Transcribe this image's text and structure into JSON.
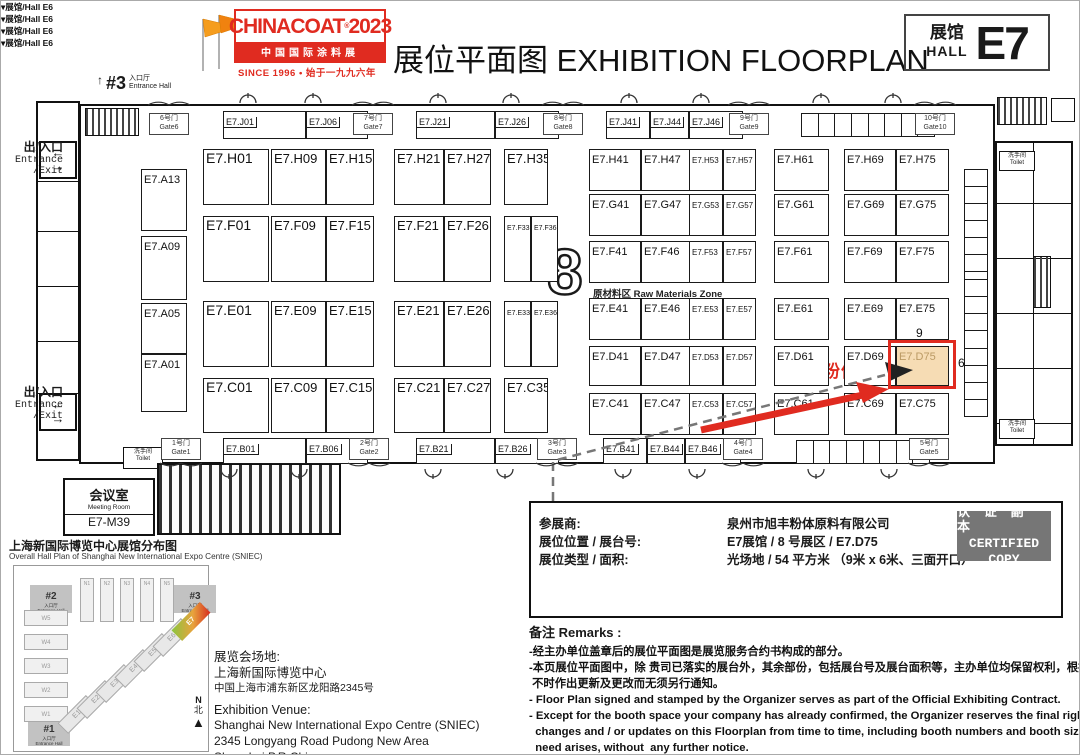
{
  "header": {
    "logo": {
      "brand": "CHINACOAT",
      "reg": "®",
      "year": "2023",
      "band": "中国国际涂料展",
      "since": "SINCE 1996 • 始于一九九六年"
    },
    "title_zh": "展位平面图",
    "title_en": "EXHIBITION FLOORPLAN",
    "hall_badge": {
      "zh": "展馆",
      "en": "HALL",
      "code": "E7"
    },
    "accent_red": "#e02b20"
  },
  "plan": {
    "entrance3": {
      "arrow": "↑",
      "num": "#3",
      "zh": "入口厅",
      "en": "Entrance Hall"
    },
    "exit_zh": "出/入口",
    "exit_en1": "Entrance",
    "exit_en2": "/Exit",
    "zone_number": "8",
    "raw_zone": "原材料区  Raw Materials Zone",
    "hall_e6": "▾展馆/Hall  E6",
    "toilet_zh": "洗手间",
    "toilet_en": "Toilet",
    "meeting": {
      "zh": "会议室",
      "en": "Meeting Room",
      "code": "E7-M39"
    },
    "highlight": {
      "company": "旭丰粉体",
      "dim_top": "9",
      "dim_right": "6",
      "booth": "E7.D75"
    },
    "arrows_updown": "← →",
    "gates_top": [
      {
        "zh": "6号门",
        "en": "Gate6",
        "x": 168
      },
      {
        "zh": "7号门",
        "en": "Gate7",
        "x": 372
      },
      {
        "zh": "8号门",
        "en": "Gate8",
        "x": 562
      },
      {
        "zh": "9号门",
        "en": "Gate9",
        "x": 748
      },
      {
        "zh": "10号门",
        "en": "Gate10",
        "x": 934
      }
    ],
    "gates_bottom": [
      {
        "zh": "1号门",
        "en": "Gate1",
        "x": 180
      },
      {
        "zh": "2号门",
        "en": "Gate2",
        "x": 368
      },
      {
        "zh": "3号门",
        "en": "Gate3",
        "x": 556
      },
      {
        "zh": "4号门",
        "en": "Gate4",
        "x": 742
      },
      {
        "zh": "5号门",
        "en": "Gate5",
        "x": 928
      }
    ],
    "hall_e6_positions": [
      186,
      376,
      752,
      938
    ],
    "booths": [
      {
        "label": "E7.J01",
        "x": 222,
        "y": 110,
        "w": 83,
        "h": 28,
        "fs": 9,
        "cell": 1
      },
      {
        "label": "E7.J06",
        "x": 305,
        "y": 110,
        "w": 62,
        "h": 28,
        "fs": 9,
        "cell": 1
      },
      {
        "label": "E7.J21",
        "x": 415,
        "y": 110,
        "w": 79,
        "h": 28,
        "fs": 9,
        "cell": 1
      },
      {
        "label": "E7.J26",
        "x": 494,
        "y": 110,
        "w": 64,
        "h": 28,
        "fs": 9,
        "cell": 1
      },
      {
        "label": "E7.J41",
        "x": 605,
        "y": 110,
        "w": 44,
        "h": 28,
        "fs": 9,
        "cell": 1
      },
      {
        "label": "E7.J44",
        "x": 649,
        "y": 110,
        "w": 39,
        "h": 28,
        "fs": 9,
        "cell": 1
      },
      {
        "label": "E7.J46",
        "x": 688,
        "y": 110,
        "w": 54,
        "h": 28,
        "fs": 9,
        "cell": 1
      },
      {
        "label": "E7.A13",
        "x": 140,
        "y": 168,
        "w": 46,
        "h": 62,
        "fs": 11
      },
      {
        "label": "E7.A09",
        "x": 140,
        "y": 235,
        "w": 46,
        "h": 64,
        "fs": 11
      },
      {
        "label": "E7.A05",
        "x": 140,
        "y": 302,
        "w": 46,
        "h": 51,
        "fs": 11
      },
      {
        "label": "E7.A01",
        "x": 140,
        "y": 353,
        "w": 46,
        "h": 58,
        "fs": 11
      },
      {
        "label": "E7.H01",
        "x": 202,
        "y": 148,
        "w": 66,
        "h": 56,
        "fs": 14
      },
      {
        "label": "E7.H09",
        "x": 270,
        "y": 148,
        "w": 55,
        "h": 56,
        "fs": 13
      },
      {
        "label": "E7.H15",
        "x": 325,
        "y": 148,
        "w": 48,
        "h": 56,
        "fs": 13
      },
      {
        "label": "E7.H21",
        "x": 393,
        "y": 148,
        "w": 50,
        "h": 56,
        "fs": 13
      },
      {
        "label": "E7.H27",
        "x": 443,
        "y": 148,
        "w": 47,
        "h": 56,
        "fs": 13
      },
      {
        "label": "E7.H35",
        "x": 503,
        "y": 148,
        "w": 44,
        "h": 56,
        "fs": 13
      },
      {
        "label": "E7.H41",
        "x": 588,
        "y": 148,
        "w": 52,
        "h": 42
      },
      {
        "label": "E7.H47",
        "x": 640,
        "y": 148,
        "w": 55,
        "h": 42
      },
      {
        "label": "E7.H53",
        "x": 688,
        "y": 148,
        "w": 34,
        "h": 42,
        "fs": 8
      },
      {
        "label": "E7.H57",
        "x": 722,
        "y": 148,
        "w": 33,
        "h": 42,
        "fs": 8
      },
      {
        "label": "E7.H61",
        "x": 773,
        "y": 148,
        "w": 55,
        "h": 42
      },
      {
        "label": "E7.H69",
        "x": 843,
        "y": 148,
        "w": 52,
        "h": 42
      },
      {
        "label": "E7.H75",
        "x": 895,
        "y": 148,
        "w": 53,
        "h": 42
      },
      {
        "label": "E7.G41",
        "x": 588,
        "y": 193,
        "w": 52,
        "h": 42
      },
      {
        "label": "E7.G47",
        "x": 640,
        "y": 193,
        "w": 55,
        "h": 42
      },
      {
        "label": "E7.G53",
        "x": 688,
        "y": 193,
        "w": 34,
        "h": 42,
        "fs": 8
      },
      {
        "label": "E7.G57",
        "x": 722,
        "y": 193,
        "w": 33,
        "h": 42,
        "fs": 8
      },
      {
        "label": "E7.G61",
        "x": 773,
        "y": 193,
        "w": 55,
        "h": 42
      },
      {
        "label": "E7.G69",
        "x": 843,
        "y": 193,
        "w": 52,
        "h": 42
      },
      {
        "label": "E7.G75",
        "x": 895,
        "y": 193,
        "w": 53,
        "h": 42
      },
      {
        "label": "E7.F01",
        "x": 202,
        "y": 215,
        "w": 66,
        "h": 66,
        "fs": 14
      },
      {
        "label": "E7.F09",
        "x": 270,
        "y": 215,
        "w": 55,
        "h": 66,
        "fs": 13
      },
      {
        "label": "E7.F15",
        "x": 325,
        "y": 215,
        "w": 48,
        "h": 66,
        "fs": 13
      },
      {
        "label": "E7.F21",
        "x": 393,
        "y": 215,
        "w": 50,
        "h": 66,
        "fs": 13
      },
      {
        "label": "E7.F26",
        "x": 443,
        "y": 215,
        "w": 47,
        "h": 66,
        "fs": 13
      },
      {
        "label": "E7.F33",
        "x": 503,
        "y": 215,
        "w": 27,
        "h": 66,
        "fs": 7
      },
      {
        "label": "E7.F36",
        "x": 530,
        "y": 215,
        "w": 27,
        "h": 66,
        "fs": 7
      },
      {
        "label": "E7.F41",
        "x": 588,
        "y": 240,
        "w": 52,
        "h": 42
      },
      {
        "label": "E7.F46",
        "x": 640,
        "y": 240,
        "w": 55,
        "h": 42
      },
      {
        "label": "E7.F53",
        "x": 688,
        "y": 240,
        "w": 34,
        "h": 42,
        "fs": 8
      },
      {
        "label": "E7.F57",
        "x": 722,
        "y": 240,
        "w": 33,
        "h": 42,
        "fs": 8
      },
      {
        "label": "E7.F61",
        "x": 773,
        "y": 240,
        "w": 55,
        "h": 42
      },
      {
        "label": "E7.F69",
        "x": 843,
        "y": 240,
        "w": 52,
        "h": 42
      },
      {
        "label": "E7.F75",
        "x": 895,
        "y": 240,
        "w": 53,
        "h": 42
      },
      {
        "label": "E7.E01",
        "x": 202,
        "y": 300,
        "w": 66,
        "h": 66,
        "fs": 14
      },
      {
        "label": "E7.E09",
        "x": 270,
        "y": 300,
        "w": 55,
        "h": 66,
        "fs": 13
      },
      {
        "label": "E7.E15",
        "x": 325,
        "y": 300,
        "w": 48,
        "h": 66,
        "fs": 13
      },
      {
        "label": "E7.E21",
        "x": 393,
        "y": 300,
        "w": 50,
        "h": 66,
        "fs": 13
      },
      {
        "label": "E7.E26",
        "x": 443,
        "y": 300,
        "w": 47,
        "h": 66,
        "fs": 13
      },
      {
        "label": "E7.E33",
        "x": 503,
        "y": 300,
        "w": 27,
        "h": 66,
        "fs": 7
      },
      {
        "label": "E7.E36",
        "x": 530,
        "y": 300,
        "w": 27,
        "h": 66,
        "fs": 7
      },
      {
        "label": "E7.E41",
        "x": 588,
        "y": 297,
        "w": 52,
        "h": 42
      },
      {
        "label": "E7.E46",
        "x": 640,
        "y": 297,
        "w": 55,
        "h": 42
      },
      {
        "label": "E7.E53",
        "x": 688,
        "y": 297,
        "w": 34,
        "h": 42,
        "fs": 8
      },
      {
        "label": "E7.E57",
        "x": 722,
        "y": 297,
        "w": 33,
        "h": 42,
        "fs": 8
      },
      {
        "label": "E7.E61",
        "x": 773,
        "y": 297,
        "w": 55,
        "h": 42
      },
      {
        "label": "E7.E69",
        "x": 843,
        "y": 297,
        "w": 52,
        "h": 42
      },
      {
        "label": "E7.E75",
        "x": 895,
        "y": 297,
        "w": 53,
        "h": 42
      },
      {
        "label": "E7.D41",
        "x": 588,
        "y": 345,
        "w": 52,
        "h": 40
      },
      {
        "label": "E7.D47",
        "x": 640,
        "y": 345,
        "w": 55,
        "h": 40
      },
      {
        "label": "E7.D53",
        "x": 688,
        "y": 345,
        "w": 34,
        "h": 40,
        "fs": 8
      },
      {
        "label": "E7.D57",
        "x": 722,
        "y": 345,
        "w": 33,
        "h": 40,
        "fs": 8
      },
      {
        "label": "E7.D61",
        "x": 773,
        "y": 345,
        "w": 55,
        "h": 40
      },
      {
        "label": "E7.D69",
        "x": 843,
        "y": 345,
        "w": 52,
        "h": 40
      },
      {
        "label": "E7.D75",
        "x": 895,
        "y": 345,
        "w": 53,
        "h": 40,
        "hl": 1
      },
      {
        "label": "E7.C01",
        "x": 202,
        "y": 377,
        "w": 66,
        "h": 55,
        "fs": 14
      },
      {
        "label": "E7.C09",
        "x": 270,
        "y": 377,
        "w": 55,
        "h": 55,
        "fs": 13
      },
      {
        "label": "E7.C15",
        "x": 325,
        "y": 377,
        "w": 48,
        "h": 55,
        "fs": 13
      },
      {
        "label": "E7.C21",
        "x": 393,
        "y": 377,
        "w": 50,
        "h": 55,
        "fs": 13
      },
      {
        "label": "E7.C27",
        "x": 443,
        "y": 377,
        "w": 47,
        "h": 55,
        "fs": 13
      },
      {
        "label": "E7.C35",
        "x": 503,
        "y": 377,
        "w": 44,
        "h": 55,
        "fs": 13
      },
      {
        "label": "E7.C41",
        "x": 588,
        "y": 392,
        "w": 52,
        "h": 42
      },
      {
        "label": "E7.C47",
        "x": 640,
        "y": 392,
        "w": 55,
        "h": 42
      },
      {
        "label": "E7.C53",
        "x": 688,
        "y": 392,
        "w": 34,
        "h": 42,
        "fs": 8
      },
      {
        "label": "E7.C57",
        "x": 722,
        "y": 392,
        "w": 33,
        "h": 42,
        "fs": 8
      },
      {
        "label": "E7.C61",
        "x": 773,
        "y": 392,
        "w": 55,
        "h": 42
      },
      {
        "label": "E7.C69",
        "x": 843,
        "y": 392,
        "w": 52,
        "h": 42
      },
      {
        "label": "E7.C75",
        "x": 895,
        "y": 392,
        "w": 53,
        "h": 42
      },
      {
        "label": "E7.B01",
        "x": 222,
        "y": 437,
        "w": 83,
        "h": 26,
        "fs": 9,
        "cell": 1
      },
      {
        "label": "E7.B06",
        "x": 305,
        "y": 437,
        "w": 62,
        "h": 26,
        "fs": 9,
        "cell": 1
      },
      {
        "label": "E7.B21",
        "x": 415,
        "y": 437,
        "w": 79,
        "h": 26,
        "fs": 9,
        "cell": 1
      },
      {
        "label": "E7.B26",
        "x": 494,
        "y": 437,
        "w": 64,
        "h": 26,
        "fs": 9,
        "cell": 1
      },
      {
        "label": "E7.B41",
        "x": 602,
        "y": 437,
        "w": 44,
        "h": 26,
        "fs": 9,
        "cell": 1
      },
      {
        "label": "E7.B44",
        "x": 646,
        "y": 437,
        "w": 38,
        "h": 26,
        "fs": 9,
        "cell": 1
      },
      {
        "label": "E7.B46",
        "x": 684,
        "y": 437,
        "w": 56,
        "h": 26,
        "fs": 9,
        "cell": 1
      }
    ],
    "strips": [
      {
        "x": 800,
        "y": 112,
        "w": 134,
        "h": 24,
        "cells": 8,
        "dir": "h"
      },
      {
        "x": 795,
        "y": 439,
        "w": 134,
        "h": 24,
        "cells": 8,
        "dir": "h"
      },
      {
        "x": 963,
        "y": 168,
        "w": 24,
        "h": 120,
        "cells": 7,
        "dir": "v"
      },
      {
        "x": 963,
        "y": 278,
        "w": 24,
        "h": 138,
        "cells": 8,
        "dir": "v"
      }
    ]
  },
  "info": {
    "rows": [
      {
        "k": "参展商:",
        "v": "泉州市旭丰粉体原料有限公司"
      },
      {
        "k": "展位位置 / 展台号:",
        "v": "E7展馆  /  8 号展区  /  E7.D75"
      },
      {
        "k": "展位类型 / 面积:",
        "v": "光场地  /  54 平方米  （9米 x 6米、三面开口）"
      }
    ],
    "certified": [
      "认 证 副 本",
      "CERTIFIED",
      "COPY"
    ]
  },
  "remarks": {
    "title": "备注  Remarks :",
    "lines": [
      "-经主办单位盖章后的展位平面图是展览服务合约书构成的部分。",
      "-本页展位平面图中，除 贵司已落实的展台外，其余部份，包括展台号及展台面积等，主办单位均保留权利，根据需要",
      " 不时作出更新及更改而无须另行通知。",
      "- Floor Plan signed and stamped by the Organizer serves as part of the Official Exhibiting Contract.",
      "- Except for the booth space your company has already confirmed, the Organizer reserves the final right to make further",
      "  changes and / or updates on this Floorplan from time to time, including booth numbers and booth sizes, etc., when the",
      "  need arises, without  any further notice."
    ]
  },
  "minimap": {
    "title_zh": "上海新国际博览中心展馆分布图",
    "title_en": "Overall Hall Plan of Shanghai New International Expo Centre (SNIEC)",
    "entrances": [
      {
        "num": "#2",
        "zh": "入口厅",
        "en": "Entrance Hall",
        "x": 28,
        "y": 583
      },
      {
        "num": "#3",
        "zh": "入口厅",
        "en": "Entrance Hall",
        "x": 172,
        "y": 583
      },
      {
        "num": "#1",
        "zh": "入口厅",
        "en": "Entrance Hall",
        "x": 26,
        "y": 716
      }
    ],
    "north": [
      "N1",
      "N2",
      "N3",
      "N4",
      "N5"
    ],
    "west": [
      "W5",
      "W4",
      "W3",
      "W2",
      "W1"
    ],
    "east": [
      "E1",
      "E2",
      "E3",
      "E4",
      "E5",
      "E6",
      "E7"
    ],
    "highlight_hall": "E7",
    "compass_n": "N",
    "compass_bei": "北",
    "compass_arrow": "▲"
  },
  "venue": {
    "zh_title": "展览会场地:",
    "zh_name": "上海新国际博览中心",
    "zh_addr": "中国上海市浦东新区龙阳路2345号",
    "en_title": "Exhibition Venue:",
    "en_name": "Shanghai New International Expo Centre (SNIEC)",
    "en_addr": "2345 Longyang Road Pudong New Area Shanghai,P.R.China"
  }
}
